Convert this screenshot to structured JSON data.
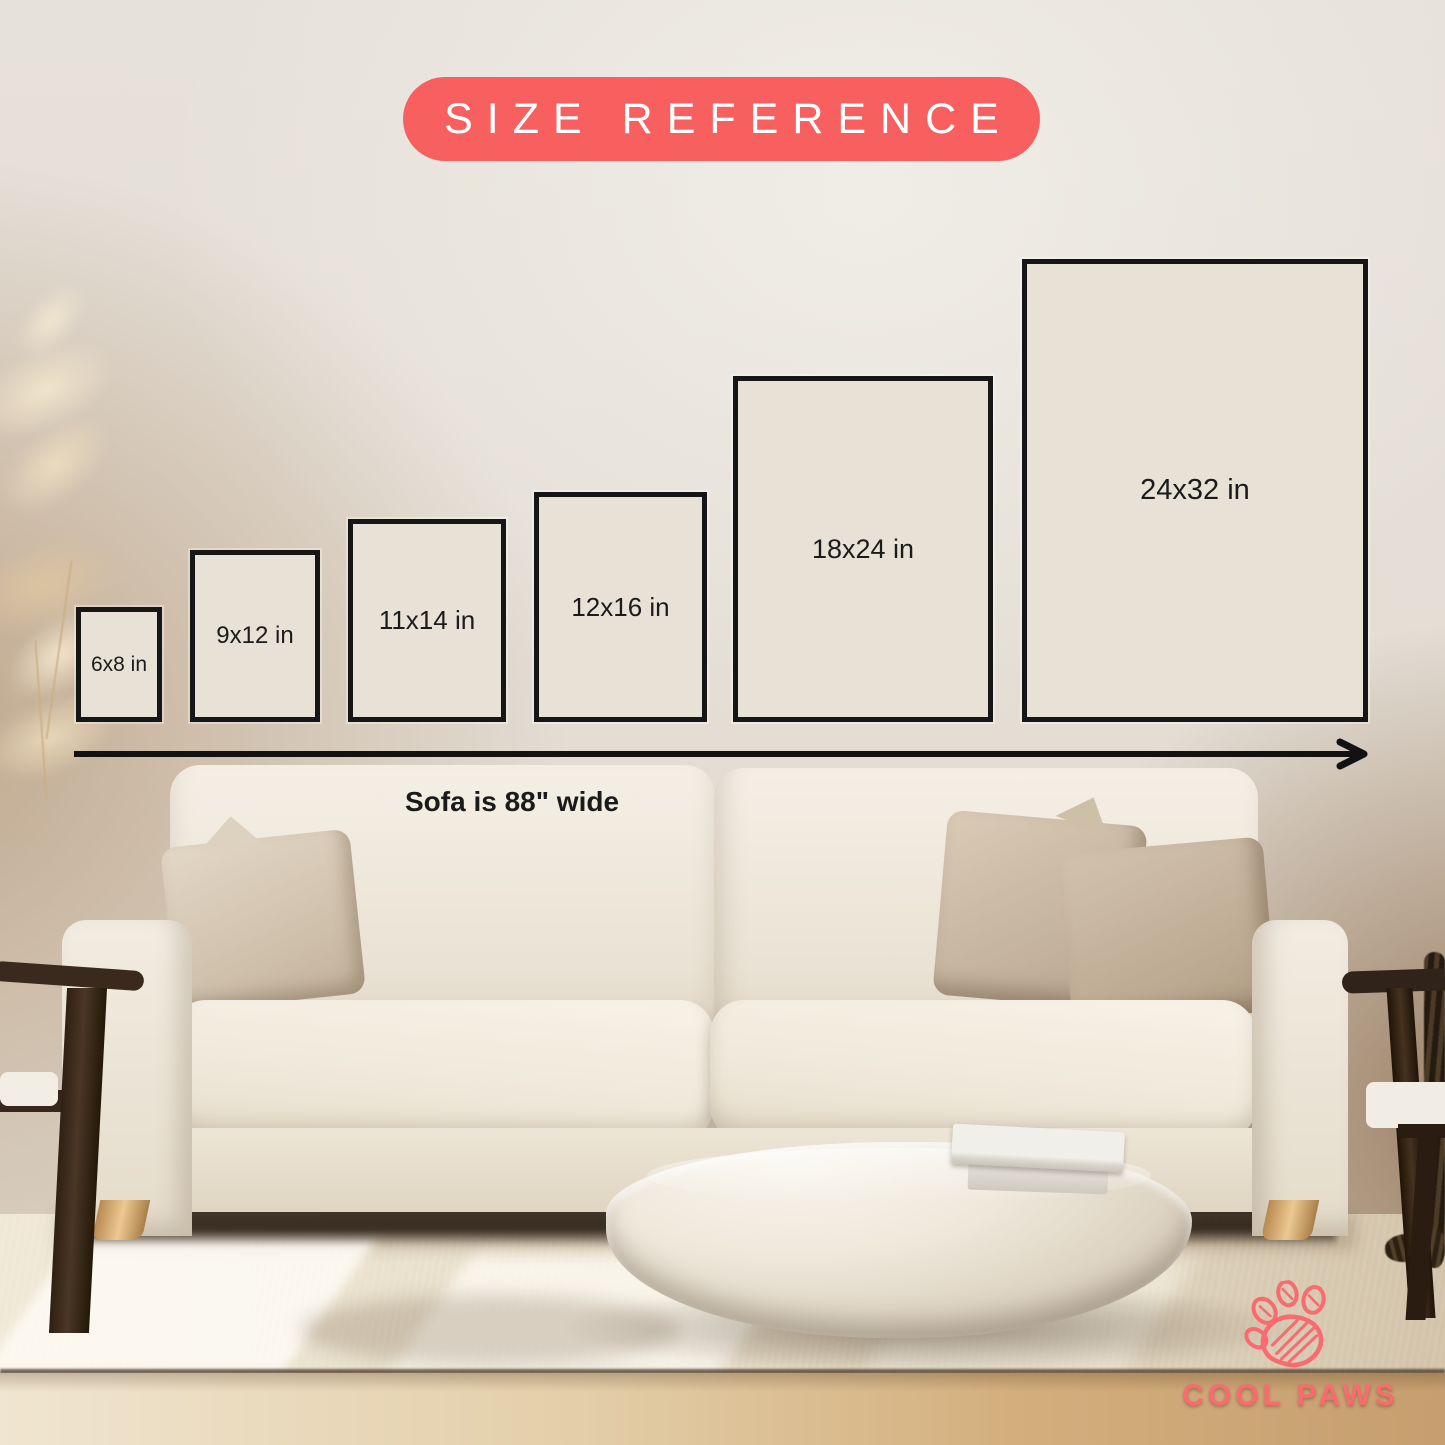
{
  "title_badge": {
    "label": "SIZE REFERENCE"
  },
  "poster_sizes": [
    {
      "label": "6x8 in",
      "width_in": 6,
      "height_in": 8
    },
    {
      "label": "9x12 in",
      "width_in": 9,
      "height_in": 12
    },
    {
      "label": "11x14 in",
      "width_in": 11,
      "height_in": 14
    },
    {
      "label": "12x16 in",
      "width_in": 12,
      "height_in": 16
    },
    {
      "label": "18x24 in",
      "width_in": 18,
      "height_in": 24
    },
    {
      "label": "24x32 in",
      "width_in": 24,
      "height_in": 32
    }
  ],
  "scale_reference": {
    "sofa_note": "Sofa is 88\" wide",
    "sofa_width_in": 88,
    "arrow_icon": "right-arrow-icon"
  },
  "brand": {
    "name": "COOL PAWS",
    "icon": "paw-print-icon"
  },
  "palette": {
    "accent": "#f7605f",
    "brand_color": "#fa6a6e",
    "poster_fill": "#e7e2d5",
    "poster_border": "#161616",
    "label_text": "#1b1b1b",
    "wall": "#e4dfd8"
  }
}
